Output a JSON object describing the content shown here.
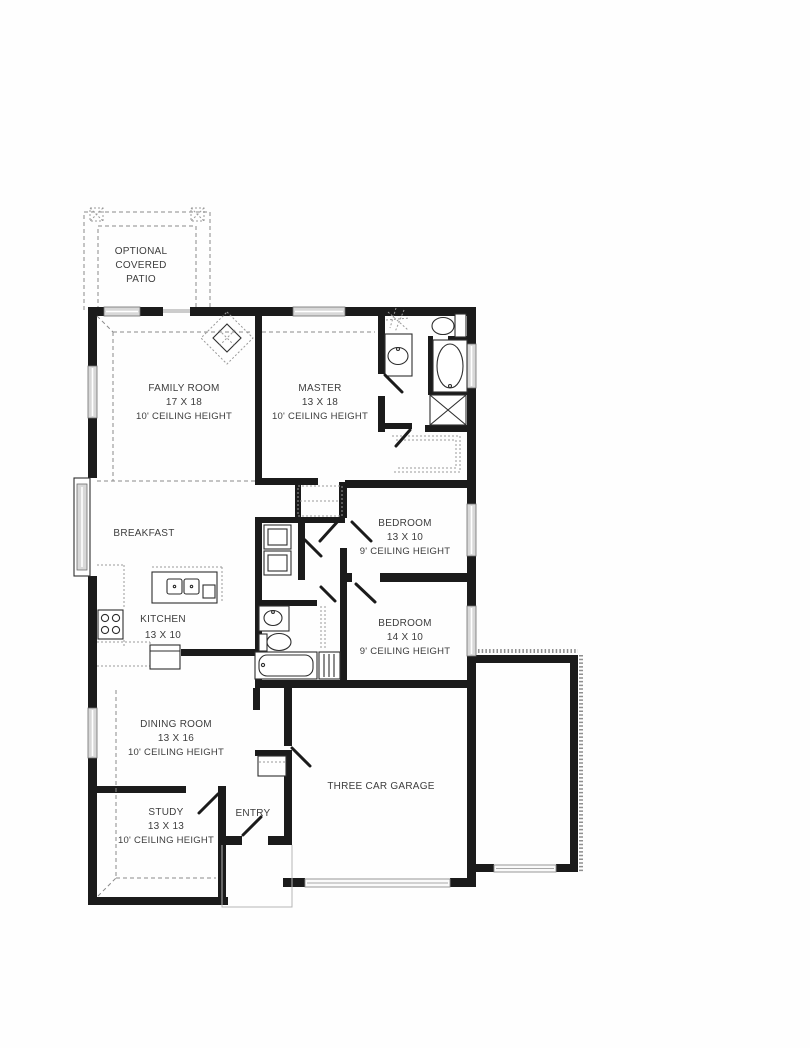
{
  "page": {
    "background": "#fefefe",
    "wall_color": "#1b1b1b",
    "text_color": "#3d3d3d",
    "window_color": "#d8d8d8"
  },
  "rooms": {
    "patio": {
      "line1": "OPTIONAL",
      "line2": "COVERED",
      "line3": "PATIO"
    },
    "family": {
      "name": "FAMILY ROOM",
      "size": "17 X 18",
      "ceiling": "10' CEILING HEIGHT"
    },
    "master": {
      "name": "MASTER",
      "size": "13 X 18",
      "ceiling": "10' CEILING HEIGHT"
    },
    "breakfast": {
      "name": "BREAKFAST"
    },
    "bedroom1": {
      "name": "BEDROOM",
      "size": "13 X 10",
      "ceiling": "9' CEILING HEIGHT"
    },
    "kitchen": {
      "name": "KITCHEN",
      "size": "13 X 10"
    },
    "bedroom2": {
      "name": "BEDROOM",
      "size": "14 X 10",
      "ceiling": "9' CEILING HEIGHT"
    },
    "dining": {
      "name": "DINING ROOM",
      "size": "13 X 16",
      "ceiling": "10' CEILING HEIGHT"
    },
    "study": {
      "name": "STUDY",
      "size": "13 X 13",
      "ceiling": "10' CEILING HEIGHT"
    },
    "entry": {
      "name": "ENTRY"
    },
    "garage": {
      "name": "THREE CAR GARAGE"
    }
  }
}
